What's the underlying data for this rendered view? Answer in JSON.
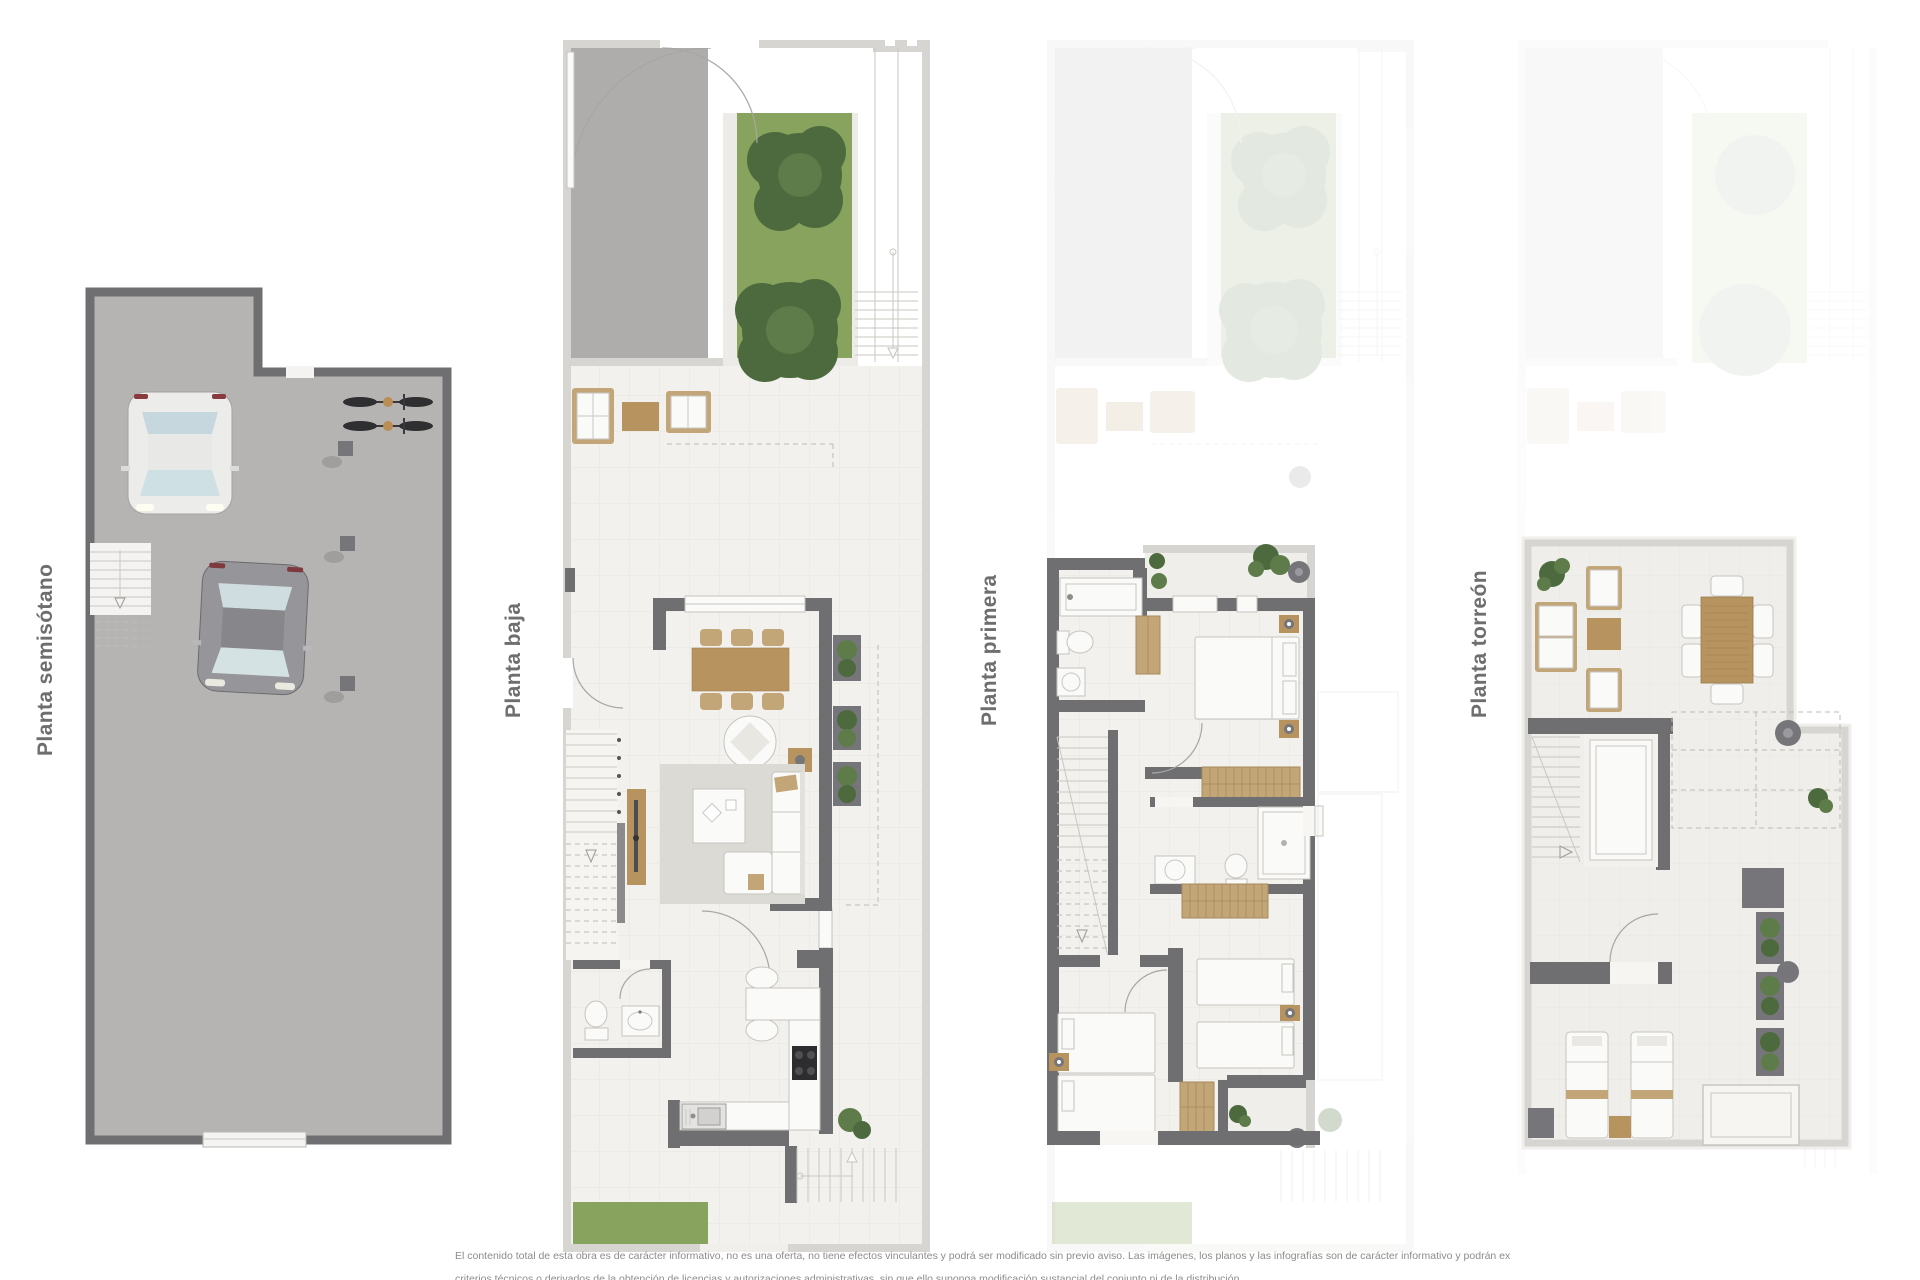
{
  "page": {
    "width": 1920,
    "height": 1280,
    "background": "#ffffff"
  },
  "plans": [
    {
      "id": "semisotano",
      "label": "Planta semisótano"
    },
    {
      "id": "baja",
      "label": "Planta baja"
    },
    {
      "id": "primera",
      "label": "Planta primera"
    },
    {
      "id": "torreon",
      "label": "Planta torreón"
    }
  ],
  "disclaimer": {
    "line1": "El contenido total de esta obra es de carácter informativo, no es una oferta, no tiene efectos vinculantes y podrá ser modificado sin previo aviso. Las imágenes, los planos y las infografías son de carácter informativo y podrán experimentar variaciones por",
    "line2_partial": "criterios técnicos o derivados de la obtención de licencias y autorizaciones administrativas, sin que ello suponga modificación sustancial del conjunto ni de la distribución"
  },
  "palette": {
    "wall": "#6f6f72",
    "wallLight": "#d6d5d2",
    "dark": "#76767a",
    "concrete": "#b5b4b2",
    "driveway": "#aeadab",
    "tile": "#efeeea",
    "interior": "#f2f1ed",
    "grass": "#87a35d",
    "treeDark": "#4c6a3d",
    "treeLight": "#5d7c49",
    "wood": "#b6935f",
    "woodFrame": "#c2a678",
    "furnitureWhite": "#fafaf9",
    "rug": "#dcdad4",
    "lineMid": "#c9c7c1",
    "labelColor": "#6e6e6e",
    "disclaimerColor": "#8c8c8c"
  }
}
